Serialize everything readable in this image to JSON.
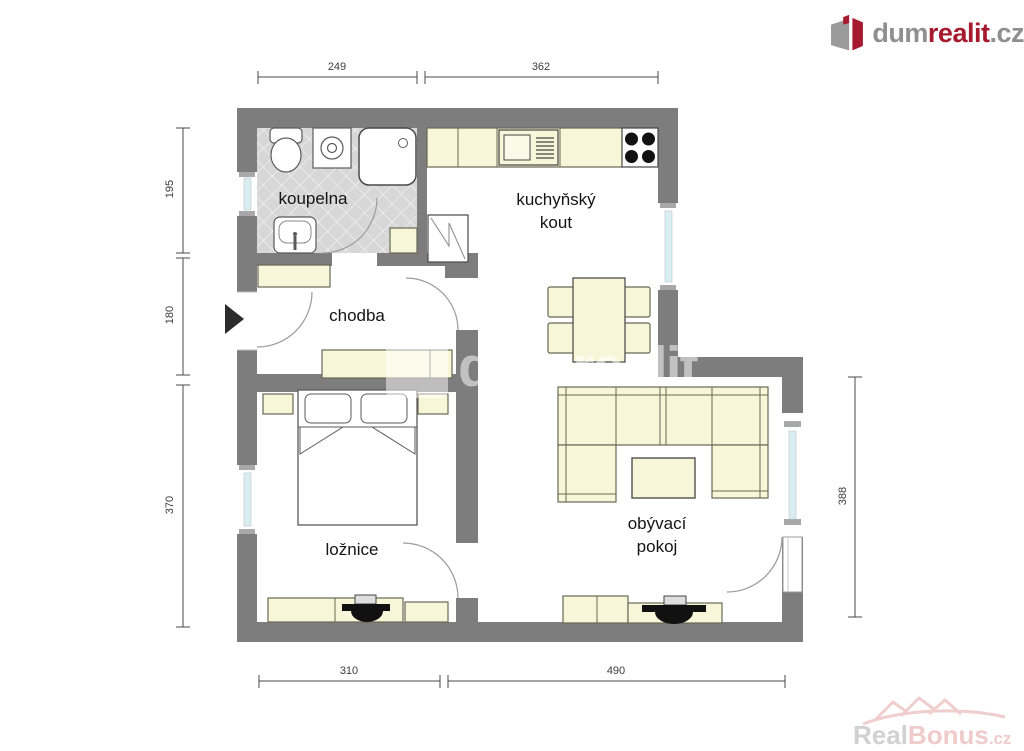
{
  "logo": {
    "prefix": "dum",
    "accent": "realit",
    "suffix": ".cz"
  },
  "rooms": {
    "bathroom": {
      "label": "koupelna"
    },
    "kitchen": {
      "line1": "kuchyňský",
      "line2": "kout"
    },
    "hall": {
      "label": "chodba"
    },
    "bedroom": {
      "label": "ložnice"
    },
    "living": {
      "line1": "obývací",
      "line2": "pokoj"
    }
  },
  "dimensions": {
    "top_left": "249",
    "top_right": "362",
    "left_upper": "195",
    "left_middle": "180",
    "left_lower": "370",
    "bottom_left": "310",
    "bottom_right": "490",
    "right_side": "388"
  },
  "watermark_center": {
    "text": "dumrealit"
  },
  "watermark_corner": {
    "prefix": "Real",
    "accent": "Bonus",
    "suffix": ".cz"
  },
  "colors": {
    "wall": "#7d7d7d",
    "furniture": "#f8f6d8",
    "bath_floor": "#d7d7d7",
    "window_glass": "#d9edf2",
    "brand_accent": "#a6192e"
  }
}
